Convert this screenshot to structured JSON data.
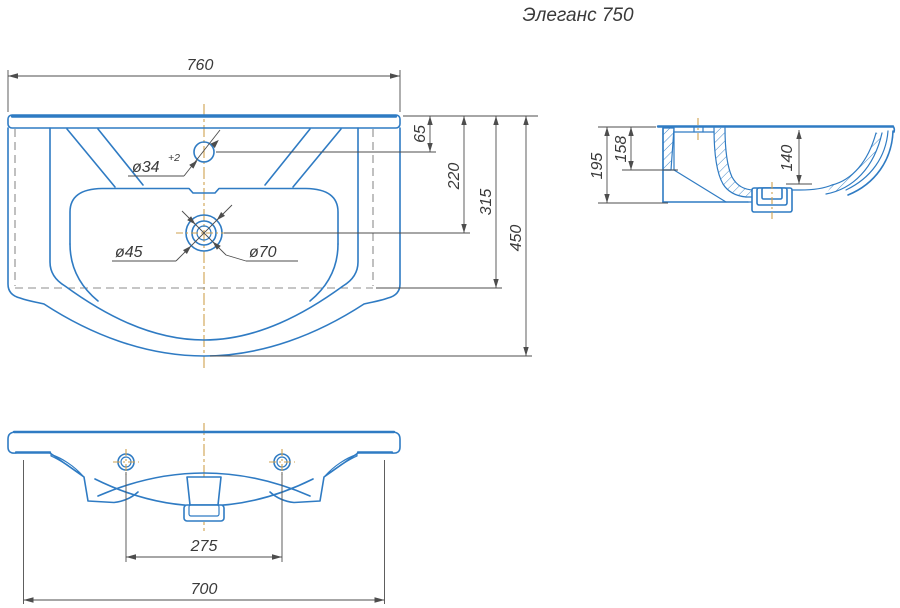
{
  "title": "Элеганс 750",
  "colors": {
    "outline_blue": "#2f7bc3",
    "dimension_gray": "#4d4d4d",
    "centerline_orange": "#cfa14f",
    "hidden_gray": "#8c8c8c",
    "text_dark": "#3a3a3a",
    "background": "#ffffff"
  },
  "views": {
    "top_view": {
      "dimensions": {
        "overall_width": "760",
        "faucet_hole_offset": "65",
        "drain_center_offset": "220",
        "body_depth": "315",
        "overall_depth": "450"
      },
      "labels": {
        "faucet_hole_diameter": "ø34",
        "faucet_hole_tolerance": "+2",
        "drain_inner_diameter": "ø45",
        "drain_outer_diameter": "ø70"
      }
    },
    "side_view": {
      "dimensions": {
        "overall_height": "195",
        "back_wall_height": "158",
        "bowl_depth": "140"
      }
    },
    "front_view": {
      "dimensions": {
        "mounting_hole_spacing": "275",
        "body_width": "700"
      }
    }
  }
}
